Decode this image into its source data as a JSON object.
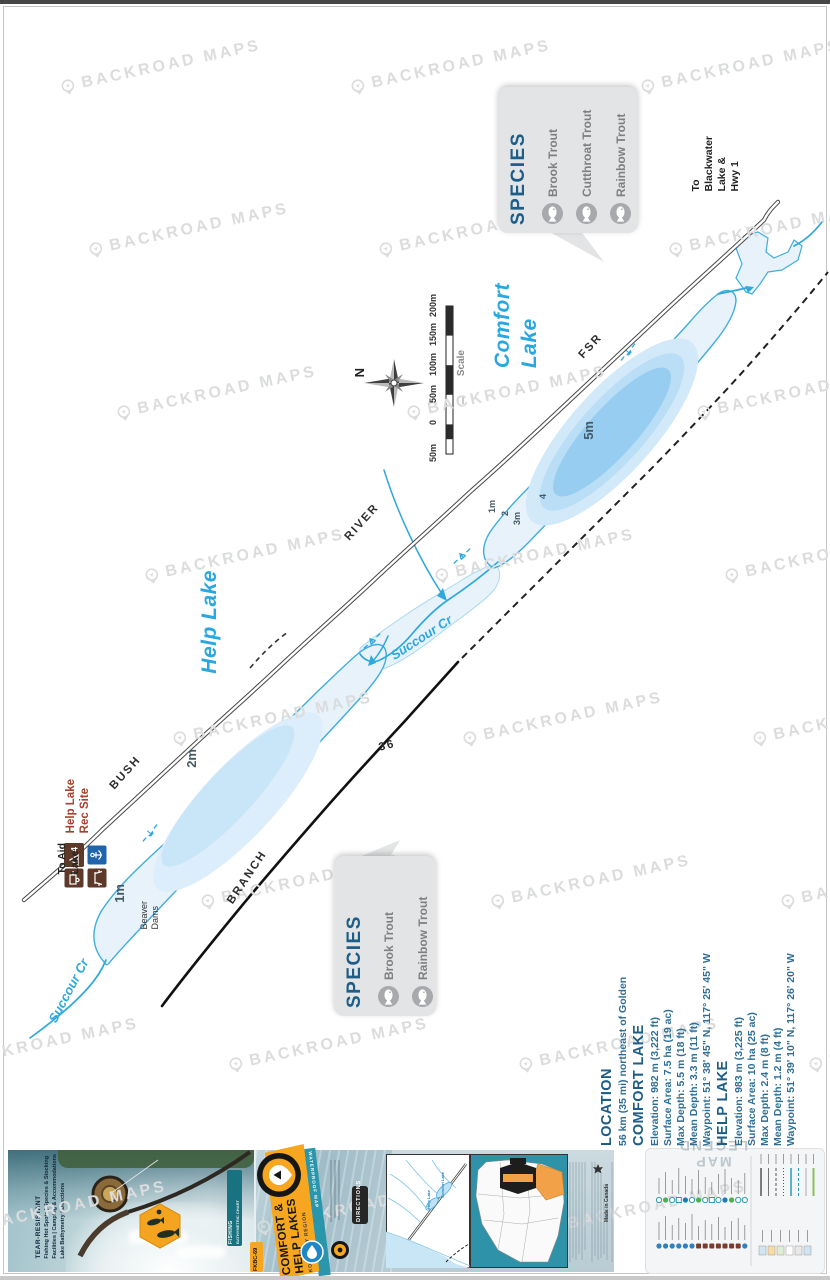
{
  "watermark": {
    "text": "BACKROAD MAPS"
  },
  "colors": {
    "lake_outline": "#3fadde",
    "lake_label": "#29a8e0",
    "heading_blue": "#1c5e88",
    "cover_orange": "#f6a61f",
    "rec_brown": "#5d3929",
    "rec_site_red": "#a8402f"
  },
  "map": {
    "labels": [
      {
        "id": "comfort-lake",
        "text": "Comfort\nLake"
      },
      {
        "id": "help-lake",
        "text": "Help Lake"
      },
      {
        "id": "bush",
        "text": "BUSH"
      },
      {
        "id": "river",
        "text": "RIVER"
      },
      {
        "id": "fsr",
        "text": "FSR"
      },
      {
        "id": "branch",
        "text": "BRANCH"
      },
      {
        "id": "r36",
        "text": "36"
      },
      {
        "id": "to-blackwater",
        "text": "To\nBlackwater\nLake &\nHwy 1"
      },
      {
        "id": "to-aid",
        "text": "To Aid\nLake"
      },
      {
        "id": "rec-site",
        "text": "Help Lake\nRec Site"
      },
      {
        "id": "succour-low",
        "text": "Succour Cr"
      },
      {
        "id": "succour-mid",
        "text": "Succour Cr"
      },
      {
        "id": "beaver",
        "text": "Beaver\nDams"
      },
      {
        "id": "d5m",
        "text": "5m"
      },
      {
        "id": "d2m",
        "text": "2m"
      },
      {
        "id": "d1mh",
        "text": "1m"
      },
      {
        "id": "d1mc",
        "text": "1m"
      },
      {
        "id": "d2c",
        "text": "2"
      },
      {
        "id": "d3mc",
        "text": "3m"
      },
      {
        "id": "d4c",
        "text": "4"
      }
    ],
    "north": "N",
    "scale": {
      "title": "Scale",
      "ticks": [
        "50m",
        "0",
        "50m",
        "100m",
        "150m",
        "200m"
      ]
    },
    "rec_site_count": "4"
  },
  "species_comfort": {
    "title": "SPECIES",
    "items": [
      "Brook Trout",
      "Cutthroat Trout",
      "Rainbow Trout"
    ]
  },
  "species_help": {
    "title": "SPECIES",
    "items": [
      "Brook Trout",
      "Rainbow Trout"
    ]
  },
  "info": {
    "location_title": "LOCATION",
    "location_text": "56 km (35 mi) northeast of Golden",
    "lakes": [
      {
        "title": "COMFORT LAKE",
        "lines": [
          "Elevation: 982 m (3,222 ft)",
          "Surface Area: 7.5 ha (19 ac)",
          "Max Depth: 5.5 m (18 ft)",
          "Mean Depth: 3.3 m (11 ft)",
          "Waypoint: 51° 38' 45\" N, 117° 25' 45\" W"
        ]
      },
      {
        "title": "HELP LAKE",
        "lines": [
          "Elevation: 983 m (3,225 ft)",
          "Surface Area: 10 ha (25 ac)",
          "Max Depth: 2.4 m (8 ft)",
          "Mean Depth: 1.2 m (4 ft)",
          "Waypoint: 51° 39' 10\" N, 117° 26' 20\" W"
        ]
      }
    ]
  },
  "strip": {
    "back_cover": {
      "tagline": "TEAR-RESISTANT",
      "features": [
        "Fishing Hot Spots | Species & Stocking",
        "Facilities | Camping & Accommodations",
        "Lake Bathymetry | Directions"
      ],
      "ribbon_line1": "FISHING",
      "ribbon_line2": "BATHYMETRIC CHART"
    },
    "front_cover": {
      "title_line1": "COMFORT &",
      "title_line2": "HELP LAKES",
      "region": "KOOTENAY REGION",
      "waterproof": "WATERPROOF MAP",
      "code": "FKBC-69",
      "directions_tab": "DIRECTIONS"
    },
    "inset_labels": {
      "help": "Help Lake",
      "comfort": "Comfort Lake"
    },
    "made_in": "Made in Canada",
    "legend_title": "MAP LEGEND"
  }
}
